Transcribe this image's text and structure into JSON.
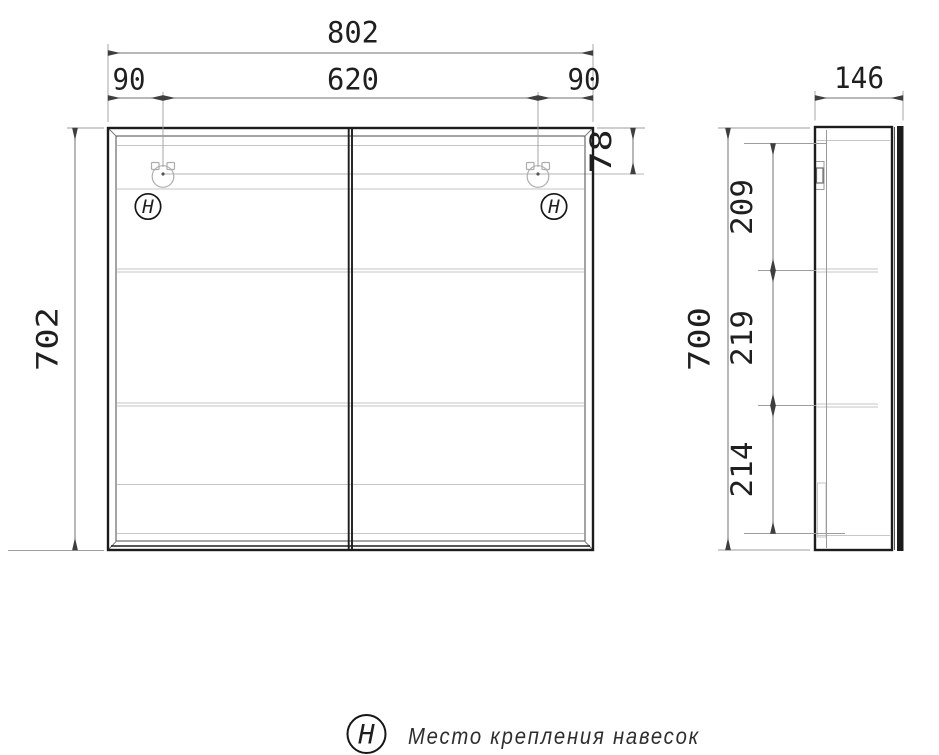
{
  "drawing": {
    "front_view": {
      "dim_total_width": "802",
      "dim_left_hanger_offset": "90",
      "dim_hanger_span": "620",
      "dim_right_hanger_offset": "90",
      "dim_height": "702",
      "dim_hanger_top_offset": "78",
      "hanger_symbol": "H"
    },
    "side_view": {
      "dim_depth": "146",
      "dim_height": "700",
      "dim_top_section": "209",
      "dim_middle_section": "219",
      "dim_bottom_section": "214"
    },
    "legend": {
      "symbol": "H",
      "text": "Место крепления навесок"
    },
    "colors": {
      "outline": "#1c1c1c",
      "dimension_line": "#707070",
      "extension_line": "#9e9e9e",
      "light_detail": "#c6c6c6",
      "background": "#ffffff"
    }
  }
}
